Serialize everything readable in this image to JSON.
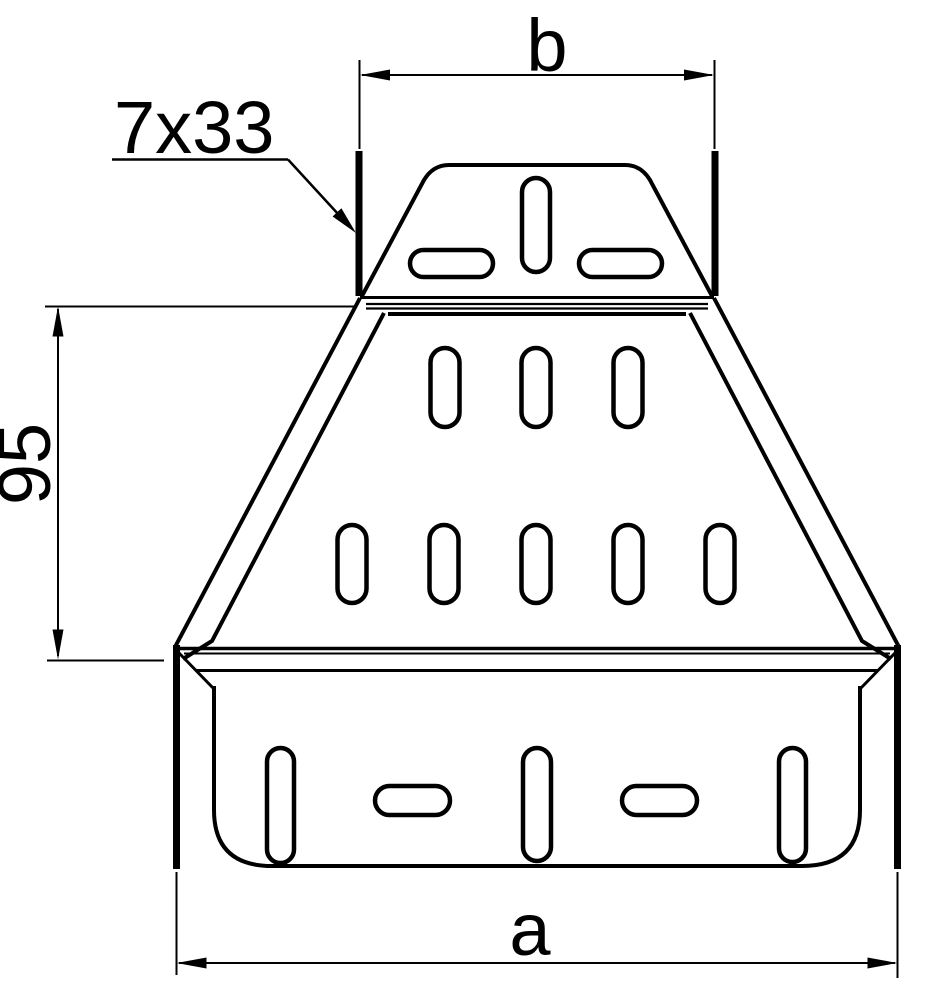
{
  "labels": {
    "top_width": "b",
    "slot_callout": "7x33",
    "left_height": "95",
    "bottom_width": "a"
  },
  "colors": {
    "line": "#000000",
    "background": "#ffffff"
  }
}
